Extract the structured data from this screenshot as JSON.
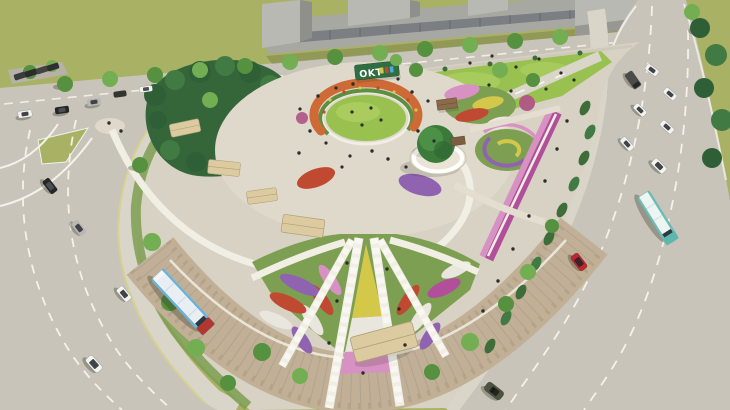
{
  "scene": {
    "description": "Aerial 3D architectural rendering of a flower garden park between two multi-lane roads, with buses, cars, lawns, parterre flower beds and gray massing buildings",
    "view": "bird's-eye perspective, daytime"
  },
  "park": {
    "sign": {
      "text": "OKT"
    },
    "features": [
      "central oval lawn",
      "orange flower arc with park sign",
      "great lawn with visitors",
      "conifer grove",
      "shade sail canopies",
      "circular tree pavilion",
      "spiral flower bed",
      "purple flower border",
      "fan-shaped flower parterre",
      "curved brick promenade",
      "hedge row along road"
    ]
  },
  "traffic": {
    "left_road": {
      "marking": "white dashed lanes, yellow curb line",
      "vehicles": [
        {
          "type": "bus",
          "colors": [
            "white",
            "blue",
            "red"
          ]
        },
        {
          "type": "car",
          "color": "black"
        },
        {
          "type": "car",
          "color": "silver"
        },
        {
          "type": "car",
          "color": "white"
        },
        {
          "type": "car",
          "color": "white"
        }
      ]
    },
    "right_road": {
      "marking": "white dashed lanes, zebra crosswalk",
      "vehicles": [
        {
          "type": "bus",
          "colors": [
            "white",
            "teal"
          ]
        },
        {
          "type": "van",
          "color": "dark gray"
        },
        {
          "type": "car",
          "color": "red"
        },
        {
          "type": "convertible",
          "color": "olive"
        },
        {
          "type": "car",
          "color": "white",
          "count": 7
        }
      ]
    },
    "top_road": {
      "vehicles": [
        {
          "type": "parked cars",
          "color": "dark",
          "count": 4
        },
        {
          "type": "car",
          "color": "white",
          "count": 2
        },
        {
          "type": "car",
          "color": "black",
          "count": 2
        },
        {
          "type": "car",
          "color": "gray",
          "count": 1
        }
      ]
    }
  },
  "buildings": {
    "style": "untextured gray massing blocks with glazing band",
    "count": 5
  },
  "palette": {
    "field": "#a9b164",
    "lawn": "#98c14f",
    "lawnLight": "#b6d36a",
    "road": "#c8c4ba",
    "roadDark": "#b7b2a8",
    "lane": "#f4f2ea",
    "laneYellow": "#d6d28a",
    "sidewalk": "#d9d5c9",
    "plaza": "#ded9cb",
    "parkBase": "#d8d2c4",
    "brick": "#c2b096",
    "path": "#f1eee4",
    "conifer": "#2f5f36",
    "coniferLight": "#417a42",
    "tree": "#55913f",
    "treeLight": "#74ae52",
    "hedge": "#3f6d3a",
    "canopy": "#dccaa1",
    "canopyEdge": "#b0a076",
    "building": "#a8a8a3",
    "buildingLight": "#b9b9b4",
    "buildingDark": "#8f8f8b",
    "glass": "#73777c",
    "flowerRed": "#c04a31",
    "flowerOrange": "#cd6a35",
    "flowerPink": "#d792c3",
    "flowerMagenta": "#b14f9a",
    "flowerPurple": "#8f63b0",
    "flowerWhite": "#e9e6de",
    "flowerYellow": "#d4c84a",
    "bedGreen": "#7d9f51",
    "signGreen": "#2e6e41",
    "busBlue": "#4fa8d8",
    "busRed": "#b23730",
    "busTeal": "#5cb8ae",
    "carWhite": "#f3f3f0",
    "carBlack": "#262626",
    "carSilver": "#b9b8b4",
    "carRed": "#c0272d",
    "carOlive": "#4d5340"
  }
}
